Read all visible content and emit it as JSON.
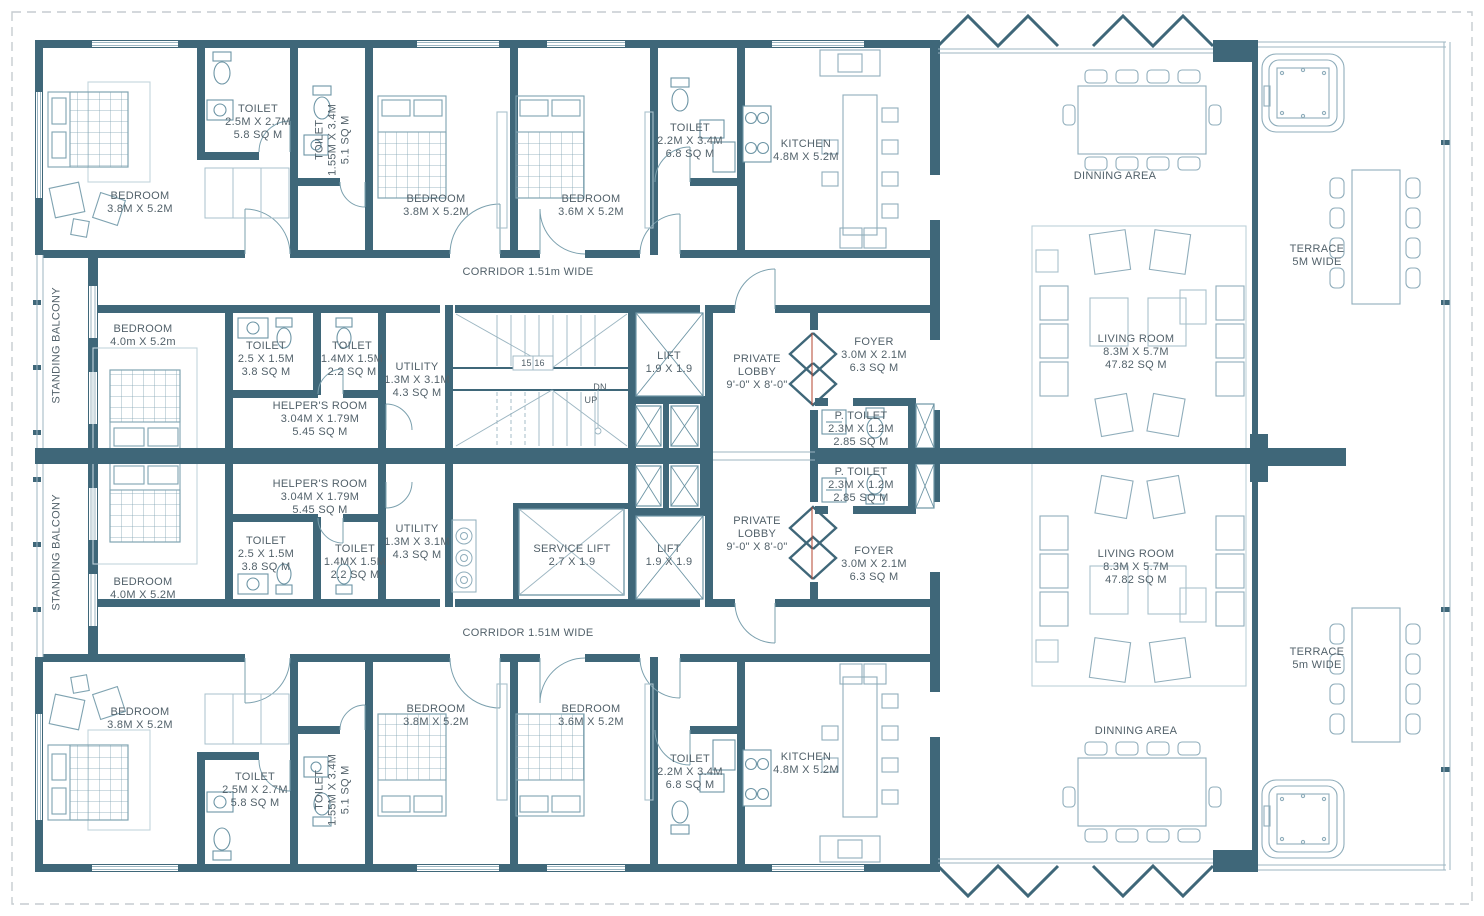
{
  "colors": {
    "wall": "#3f6779",
    "thin_line": "#7ba0ae",
    "furniture": "#8fadbb",
    "text": "#52616a"
  },
  "labels": {
    "toilet_tl": {
      "l1": "TOILET",
      "l2": "2.5M X 2.7M",
      "l3": "5.8 SQ M"
    },
    "toilet_tl_vert": {
      "l1": "TOILET",
      "l2": "1.55M X 3.4M",
      "l3": "5.1 SQ M"
    },
    "bedroom_tl": {
      "l1": "BEDROOM",
      "l2": "3.8M X 5.2M"
    },
    "bedroom_tm": {
      "l1": "BEDROOM",
      "l2": "3.8M X 5.2M"
    },
    "bedroom_tr": {
      "l1": "BEDROOM",
      "l2": "3.6M X 5.2M"
    },
    "toilet_t3": {
      "l1": "TOILET",
      "l2": "2.2M X 3.4M",
      "l3": "6.8 SQ M"
    },
    "kitchen_t": {
      "l1": "KITCHEN",
      "l2": "4.8M X 5.2M"
    },
    "dining_t": {
      "l1": "DINNING AREA"
    },
    "terrace_t": {
      "l1": "TERRACE",
      "l2": "5M WIDE"
    },
    "corridor_t": {
      "l1": "CORRIDOR 1.51m WIDE"
    },
    "standing_balcony_t": {
      "l1": "STANDING BALCONY"
    },
    "bedroom_ml": {
      "l1": "BEDROOM",
      "l2": "4.0m X 5.2m"
    },
    "toilet_m1_t": {
      "l1": "TOILET",
      "l2": "2.5 X 1.5M",
      "l3": "3.8 SQ M"
    },
    "toilet_m2_t": {
      "l1": "TOILET",
      "l2": "1.4MX 1.5M",
      "l3": "2.2 SQ M"
    },
    "helpers_t": {
      "l1": "HELPER'S ROOM",
      "l2": "3.04M X 1.79M",
      "l3": "5.45 SQ M"
    },
    "utility_t": {
      "l1": "UTILITY",
      "l2": "1.3M X 3.1M",
      "l3": "4.3 SQ M"
    },
    "stairs": {
      "nums": "15 16",
      "dn": "DN",
      "up": "UP"
    },
    "lift_t": {
      "l1": "LIFT",
      "l2": "1.9 X 1.9"
    },
    "lobby_t": {
      "l1": "PRIVATE LOBBY",
      "l2": "9'-0\" X 8'-0\""
    },
    "foyer_t": {
      "l1": "FOYER",
      "l2": "3.0M X 2.1M",
      "l3": "6.3 SQ M"
    },
    "ptoilet_t": {
      "l1": "P. TOILET",
      "l2": "2.3M X 1.2M",
      "l3": "2.85 SQ M"
    },
    "living_t": {
      "l1": "LIVING ROOM",
      "l2": "8.3M X 5.7M",
      "l3": "47.82 SQ M"
    },
    "ptoilet_b": {
      "l1": "P. TOILET",
      "l2": "2.3M X 1.2M",
      "l3": "2.85 SQ M"
    },
    "helpers_b": {
      "l1": "HELPER'S ROOM",
      "l2": "3.04M X 1.79M",
      "l3": "5.45 SQ M"
    },
    "toilet_m1_b": {
      "l1": "TOILET",
      "l2": "2.5 X 1.5M",
      "l3": "3.8 SQ M"
    },
    "toilet_m2_b": {
      "l1": "TOILET",
      "l2": "1.4MX 1.5M",
      "l3": "2.2 SQ M"
    },
    "utility_b": {
      "l1": "UTILITY",
      "l2": "1.3M X 3.1M",
      "l3": "4.3 SQ M"
    },
    "service_lift": {
      "l1": "SERVICE LIFT",
      "l2": "2.7 X 1.9"
    },
    "lift_b": {
      "l1": "LIFT",
      "l2": "1.9 X 1.9"
    },
    "lobby_b": {
      "l1": "PRIVATE LOBBY",
      "l2": "9'-0\" X 8'-0\""
    },
    "foyer_b": {
      "l1": "FOYER",
      "l2": "3.0M X 2.1M",
      "l3": "6.3 SQ M"
    },
    "bedroom_mlb": {
      "l1": "BEDROOM",
      "l2": "4.0M X 5.2M"
    },
    "living_b": {
      "l1": "LIVING ROOM",
      "l2": "8.3M X 5.7M",
      "l3": "47.82 SQ M"
    },
    "standing_balcony_b": {
      "l1": "STANDING BALCONY"
    },
    "corridor_b": {
      "l1": "CORRIDOR 1.51M WIDE"
    },
    "bedroom_bl": {
      "l1": "BEDROOM",
      "l2": "3.8M X 5.2M"
    },
    "toilet_bl": {
      "l1": "TOILET",
      "l2": "2.5M X 2.7M",
      "l3": "5.8 SQ M"
    },
    "toilet_bl_vert": {
      "l1": "TOILET",
      "l2": "1.55M X 3.4M",
      "l3": "5.1 SQ M"
    },
    "bedroom_bm": {
      "l1": "BEDROOM",
      "l2": "3.8M X 5.2M"
    },
    "bedroom_br": {
      "l1": "BEDROOM",
      "l2": "3.6M X 5.2M"
    },
    "toilet_b3": {
      "l1": "TOILET",
      "l2": "2.2M X 3.4M",
      "l3": "6.8 SQ M"
    },
    "kitchen_b": {
      "l1": "KITCHEN",
      "l2": "4.8M X 5.2M"
    },
    "dining_b": {
      "l1": "DINNING AREA"
    },
    "terrace_b": {
      "l1": "TERRACE",
      "l2": "5m WIDE"
    }
  }
}
